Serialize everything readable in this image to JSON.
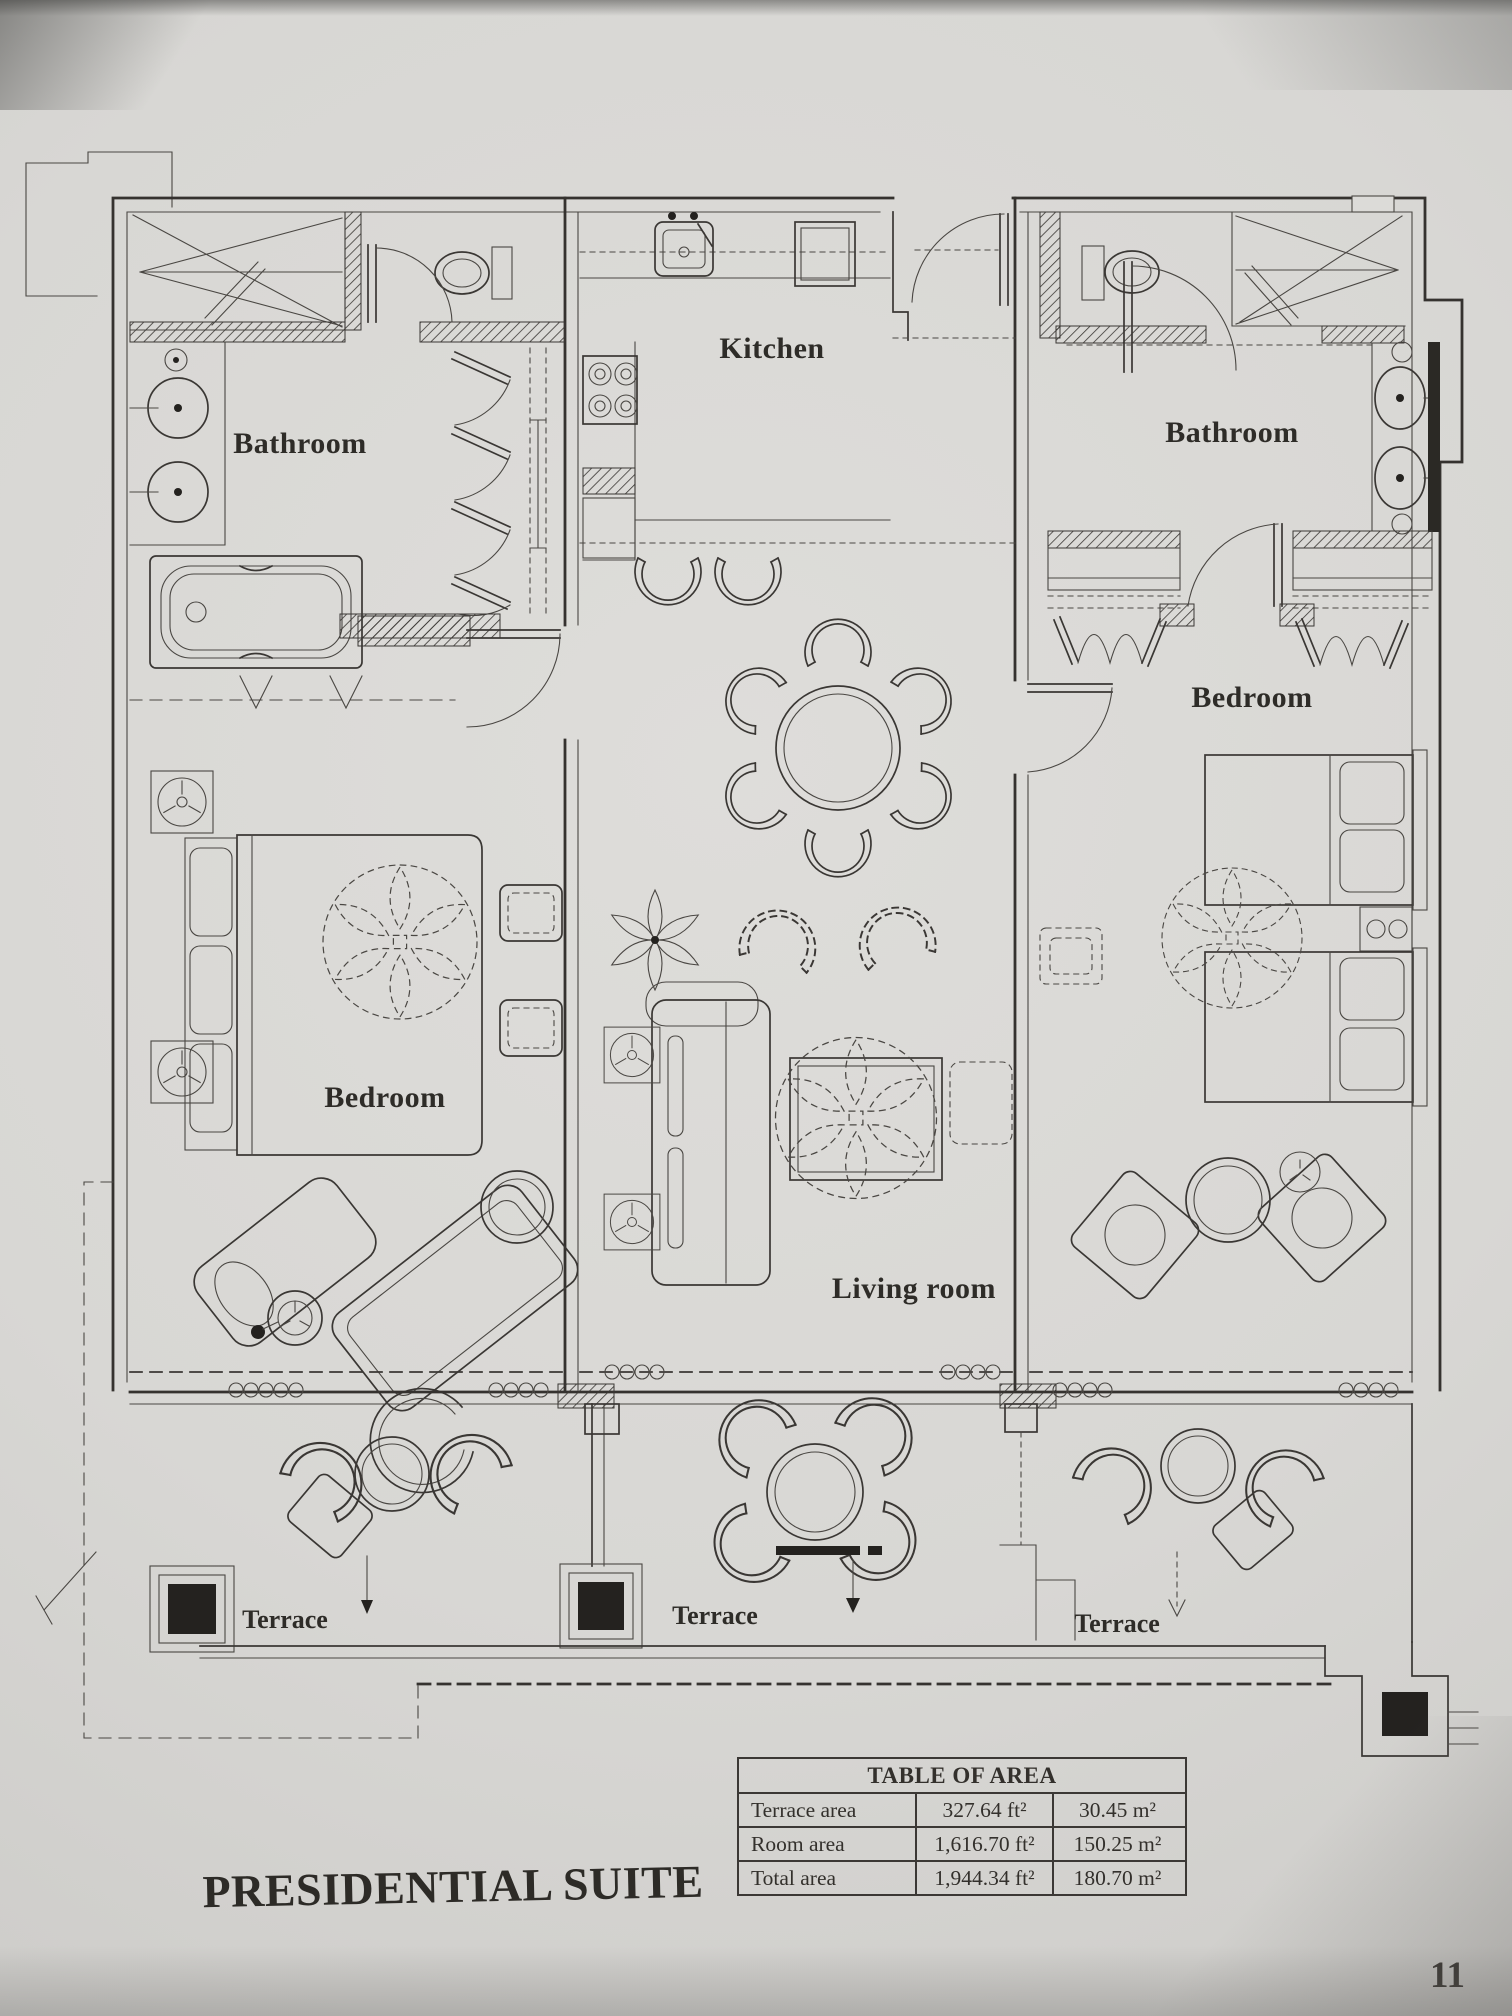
{
  "document": {
    "title": "PRESIDENTIAL SUITE",
    "page_number": "11"
  },
  "labels": {
    "bathroom_left": "Bathroom",
    "kitchen": "Kitchen",
    "bathroom_right": "Bathroom",
    "bedroom_left": "Bedroom",
    "bedroom_right": "Bedroom",
    "living_room": "Living room",
    "terrace_left": "Terrace",
    "terrace_center": "Terrace",
    "terrace_right": "Terrace"
  },
  "area_table": {
    "title": "TABLE OF AREA",
    "rows": [
      {
        "label": "Terrace area",
        "imperial": "327.64 ft²",
        "metric": "30.45 m²"
      },
      {
        "label": "Room area",
        "imperial": "1,616.70 ft²",
        "metric": "150.25 m²"
      },
      {
        "label": "Total area",
        "imperial": "1,944.34 ft²",
        "metric": "180.70 m²"
      }
    ]
  },
  "colors": {
    "ink": "#3a3734",
    "paper": "#d8d7d4",
    "column_fill": "#24221f"
  }
}
